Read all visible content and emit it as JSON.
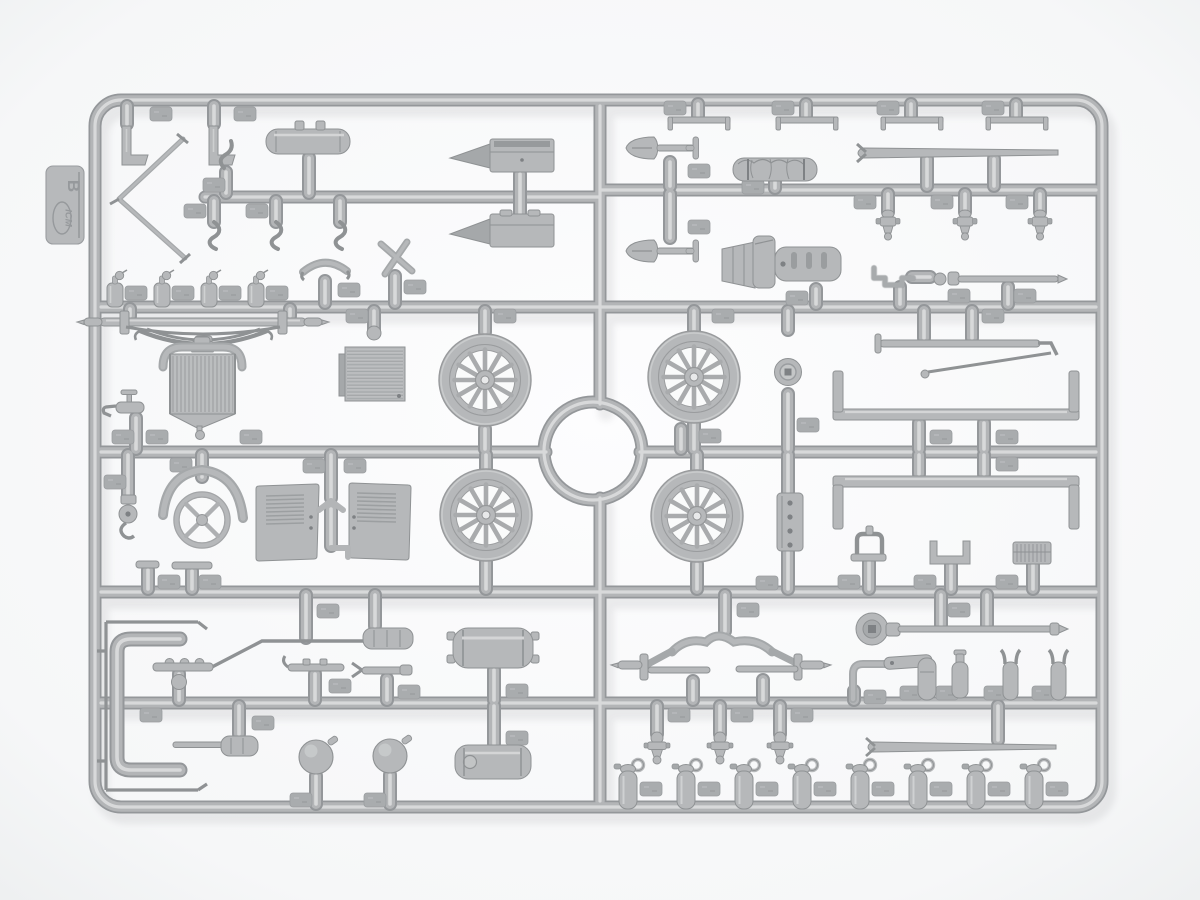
{
  "tag": {
    "brand": "ICM",
    "letter": "B"
  },
  "scene": {
    "description": "Light-gray injection-molded plastic model kit sprue (frame B) photographed on a white background; rectangular runner frame with internal runners, center ring, and many attached parts.",
    "parts": [
      "l-bracket",
      "l-bracket",
      "fuel-tank-cylinder",
      "windshield-frame",
      "s-hook",
      "s-hook",
      "s-hook",
      "tool-box-with-wedge-mount",
      "tool-box-with-wedge-mount",
      "cross-brace",
      "seat-bow",
      "oil-can",
      "oil-can",
      "oil-can",
      "oil-can",
      "top-bracket",
      "top-bracket",
      "top-bracket",
      "top-bracket",
      "shovel",
      "shovel",
      "rolled-tarp",
      "pry-bar",
      "transmission-pan",
      "valve-spool",
      "valve-spool",
      "valve-spool",
      "hand-crank",
      "starter-rod",
      "front-axle-with-leaf-spring",
      "radiator",
      "water-tap",
      "floor-panel",
      "spoked-wheel",
      "spoked-wheel",
      "spoked-wheel",
      "spoked-wheel",
      "steering-wheel",
      "top-bow",
      "pulley-hook-block",
      "hood-side-panel",
      "hood-side-panel",
      "tie-rod-with-drag-link",
      "horn",
      "chassis-rail",
      "chassis-rail",
      "bolted-plate",
      "tap-handle-bracket",
      "channel-box",
      "grille-block",
      "exhaust-pipe-with-rods",
      "running-board-bracket",
      "brake-rod",
      "muffler-cylinder",
      "fork-lever",
      "fork-lever",
      "fuel-tank",
      "storage-tank",
      "ball-lamp",
      "ball-lamp",
      "coil-cylinder",
      "rear-axle-with-radius-rods",
      "crank-handle-disc",
      "elbow-pipe-with-link",
      "small-cylinder",
      "small-bottle",
      "fork-fitting",
      "fork-fitting",
      "pry-bar",
      "carburetor-spool",
      "carburetor-spool",
      "carburetor-spool",
      "grease-cup",
      "grease-cup",
      "grease-cup",
      "grease-cup",
      "grease-cup",
      "grease-cup",
      "grease-cup",
      "grease-cup"
    ],
    "wheel_count": 4,
    "grease_cup_count": 8
  },
  "palette": {
    "bg1": "#fdfdfe",
    "bg2": "#edeff0",
    "t_edge": "#94979a",
    "t_mid": "#b3b5b7",
    "t_hl": "#d8d9da",
    "p_base": "#b6b8ba",
    "p_edge": "#8f9294",
    "p_shade": "#a5a8aa",
    "p_hl": "#d4d5d6",
    "p_dark": "#7e8184",
    "tab_fill": "#a9acae",
    "tab_edge": "#9a9da0"
  }
}
